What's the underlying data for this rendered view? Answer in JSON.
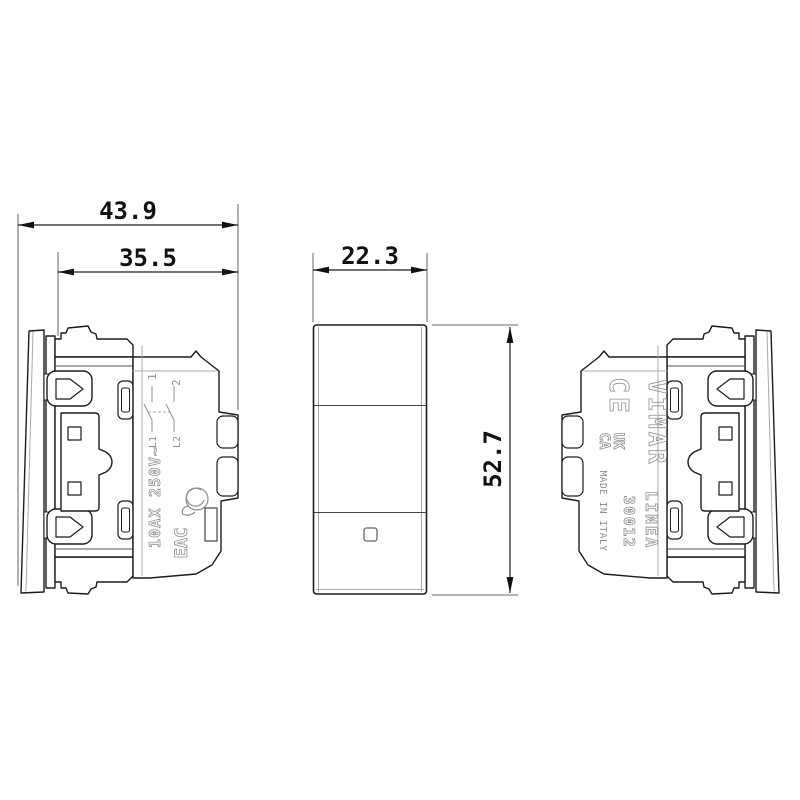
{
  "dimensions": {
    "total_depth_mm": "43.9",
    "mount_depth_mm": "35.5",
    "width_mm": "22.3",
    "height_mm": "52.7"
  },
  "left_view_markings": {
    "terminal_1": "1",
    "terminal_2": "2",
    "terminal_l1": "L1",
    "terminal_l2": "L2",
    "rating": "10AX 250V~",
    "eac_mark": "EAC"
  },
  "right_view_markings": {
    "ce_mark": "CE",
    "ukca_line1": "UK",
    "ukca_line2": "CA",
    "brand": "VIMAR",
    "made_in": "MADE IN ITALY",
    "series": "LINEA",
    "model": "30012"
  },
  "colors": {
    "line": "#1c1c1c",
    "thin_line": "#555555",
    "light_line": "#aaaaaa",
    "molded_text": "#8f8f8f",
    "background": "#ffffff"
  }
}
